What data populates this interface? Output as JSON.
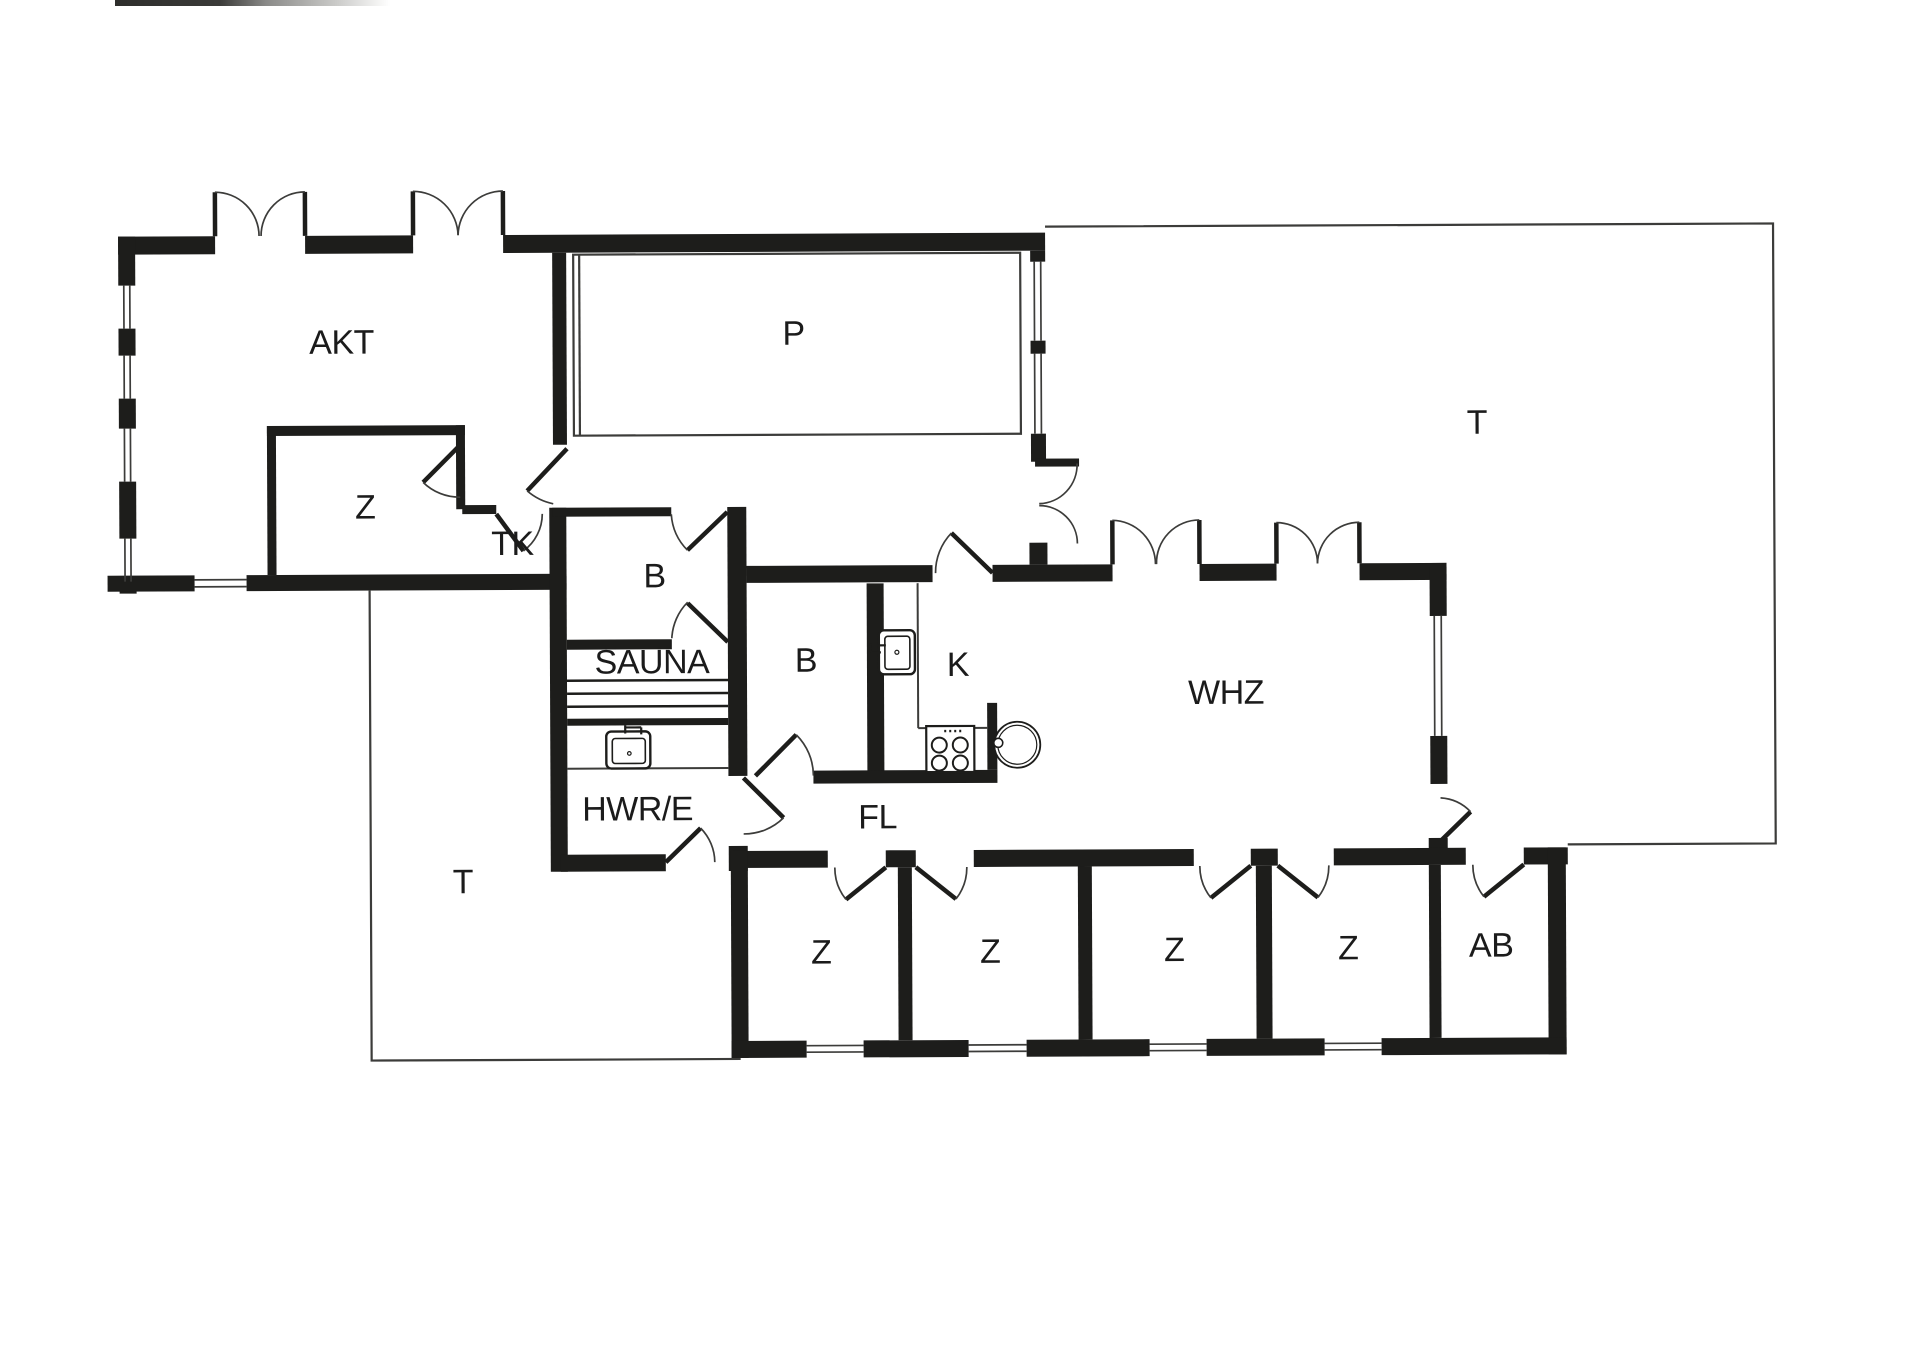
{
  "colors": {
    "walls": "#1d1d1b",
    "lines": "#3c3c3a",
    "label_text": "#1b1b1b",
    "background": "#ffffff"
  },
  "rooms": [
    {
      "id": "akt",
      "label": "AKT",
      "x": 343,
      "y": 340
    },
    {
      "id": "pool",
      "label": "P",
      "x": 795,
      "y": 333
    },
    {
      "id": "terrace-east",
      "label": "T",
      "x": 1478,
      "y": 425
    },
    {
      "id": "z-akt",
      "label": "Z",
      "x": 366,
      "y": 505
    },
    {
      "id": "tk",
      "label": "TK",
      "x": 513,
      "y": 542
    },
    {
      "id": "bath-north",
      "label": "B",
      "x": 655,
      "y": 575
    },
    {
      "id": "sauna",
      "label": "SAUNA",
      "x": 652,
      "y": 661
    },
    {
      "id": "bath-middle",
      "label": "B",
      "x": 806,
      "y": 660
    },
    {
      "id": "kitchen",
      "label": "K",
      "x": 958,
      "y": 665
    },
    {
      "id": "whz",
      "label": "WHZ",
      "x": 1226,
      "y": 694
    },
    {
      "id": "hwr-e",
      "label": "HWR/E",
      "x": 637,
      "y": 808
    },
    {
      "id": "fl",
      "label": "FL",
      "x": 877,
      "y": 817
    },
    {
      "id": "terrace-west",
      "label": "T",
      "x": 462,
      "y": 880
    },
    {
      "id": "z1",
      "label": "Z",
      "x": 820,
      "y": 952
    },
    {
      "id": "z2",
      "label": "Z",
      "x": 989,
      "y": 952
    },
    {
      "id": "z3",
      "label": "Z",
      "x": 1173,
      "y": 951
    },
    {
      "id": "z4",
      "label": "Z",
      "x": 1347,
      "y": 950
    },
    {
      "id": "ab",
      "label": "AB",
      "x": 1490,
      "y": 948
    }
  ],
  "fixtures": {
    "stove_icon": "four-burner stove",
    "kitchen_sink_icon": "kitchen sink with faucet",
    "utility_sink_icon": "utility sink with faucet",
    "dining_table_icon": "round table",
    "sauna_benches": "sauna bench slats"
  }
}
